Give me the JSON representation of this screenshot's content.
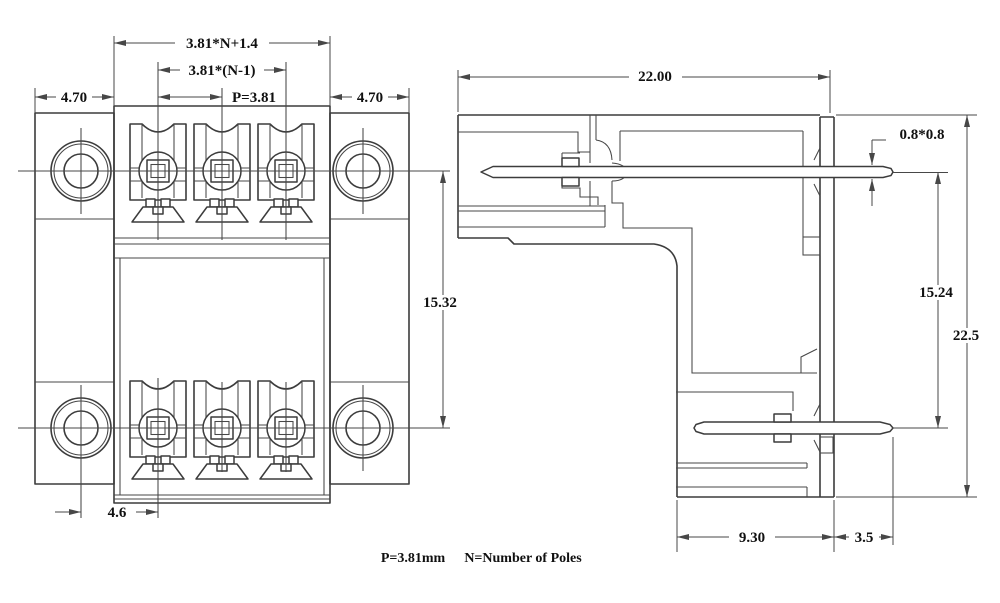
{
  "front_view": {
    "dims": {
      "total_width": "3.81*N+1.4",
      "inner_width": "3.81*(N-1)",
      "pitch": "P=3.81",
      "flange_left": "4.70",
      "flange_right": "4.70",
      "row_spacing": "15.32",
      "hole_to_pole": "4.6"
    }
  },
  "side_view": {
    "dims": {
      "depth": "22.00",
      "pin_section": "0.8*0.8",
      "pin_row_spacing": "15.24",
      "height": "22.5",
      "body_depth": "9.30",
      "pin_protrusion": "3.5"
    }
  },
  "note": {
    "pitch": "P=3.81mm",
    "poles": "N=Number of Poles"
  },
  "colors": {
    "line": "#3c3c3c",
    "text": "#101010",
    "background": "#ffffff"
  }
}
